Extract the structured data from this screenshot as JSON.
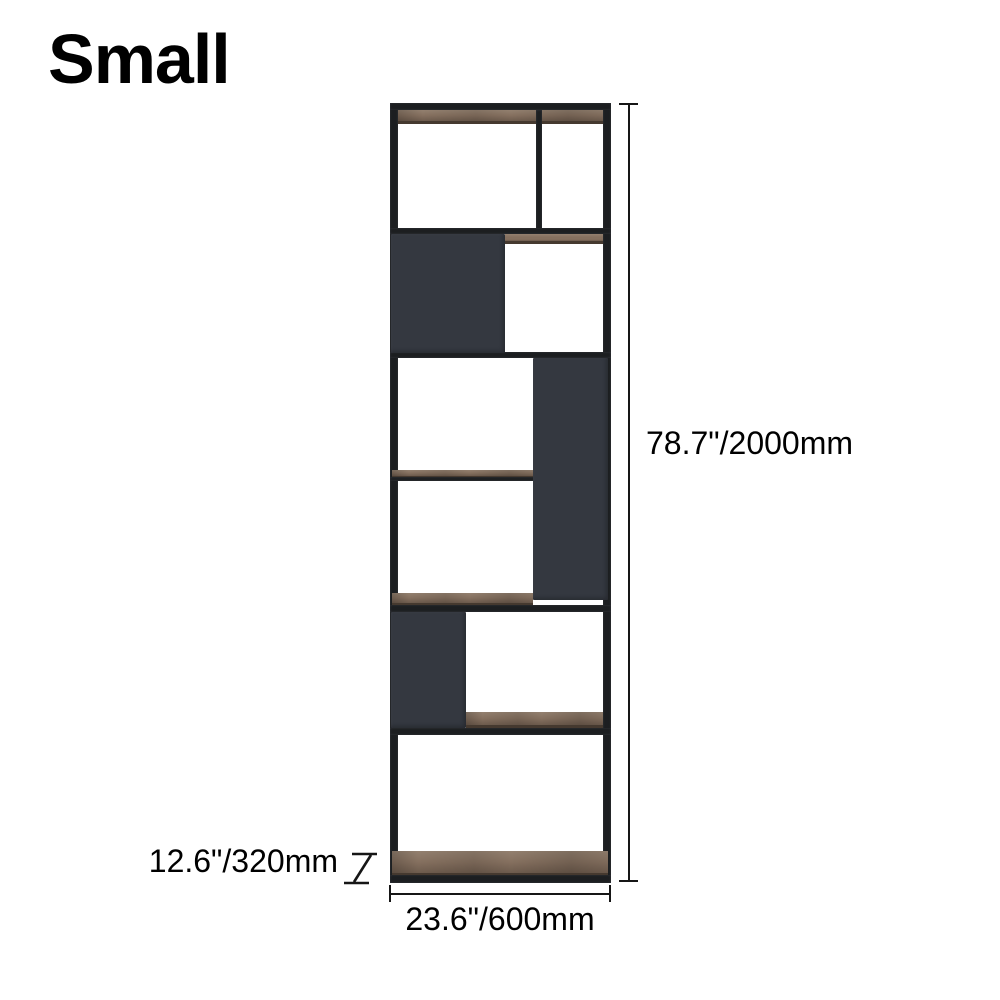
{
  "title": {
    "label": "Small"
  },
  "illustration": {
    "name": "geometric bookshelf front view"
  },
  "dimensions": {
    "height": {
      "label": "78.7\"/2000mm"
    },
    "width": {
      "label": "23.6\"/600mm"
    },
    "depth": {
      "label": "12.6\"/320mm"
    }
  },
  "colors": {
    "background": "#ffffff",
    "text": "#000000",
    "frame": "#1c1e21",
    "frame_light": "#35383d",
    "panel": "#343840",
    "wood": "#85705f",
    "wood_light": "#93806f",
    "wood_dark": "#45392f",
    "dimension": "#161616"
  }
}
